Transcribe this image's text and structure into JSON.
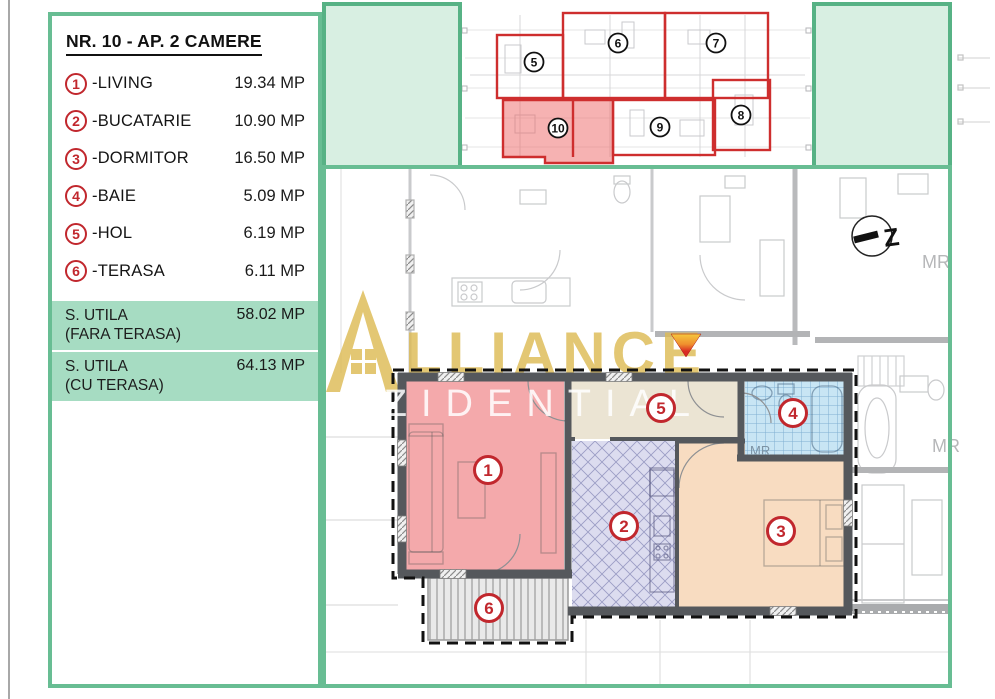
{
  "legend": {
    "title": "NR. 10 - AP. 2 CAMERE",
    "items": [
      {
        "num": "1",
        "label": "-LIVING",
        "value": "19.34 MP"
      },
      {
        "num": "2",
        "label": "-BUCATARIE",
        "value": "10.90 MP"
      },
      {
        "num": "3",
        "label": "-DORMITOR",
        "value": "16.50 MP"
      },
      {
        "num": "4",
        "label": "-BAIE",
        "value": "5.09 MP"
      },
      {
        "num": "5",
        "label": "-HOL",
        "value": "6.19 MP"
      },
      {
        "num": "6",
        "label": "-TERASA",
        "value": "6.11 MP"
      }
    ],
    "totals": [
      {
        "label": "S. UTILA",
        "sub": "(FARA TERASA)",
        "value": "58.02 MP"
      },
      {
        "label": "S. UTILA",
        "sub": "(CU TERASA)",
        "value": "64.13 MP"
      }
    ]
  },
  "overview": {
    "units": [
      "5",
      "6",
      "7",
      "8",
      "9",
      "10"
    ],
    "highlighted_unit": "10"
  },
  "plan": {
    "room_badges": [
      "1",
      "2",
      "3",
      "4",
      "5",
      "6"
    ],
    "mr_labels": [
      "MR",
      "MR",
      "MR"
    ],
    "north_label": "Z"
  },
  "watermark": {
    "brand_visible_text": "LLIANCE",
    "sub": "REZIDENTIAL"
  },
  "colors": {
    "frame_green": "#68bd93",
    "light_green_fill": "#d8efe2",
    "totals_green": "#a6dcc2",
    "badge_red": "#c1272d",
    "overview_red": "#ce2e2e",
    "living_pink": "#f4a9ab",
    "hol_beige": "#ebe4d3",
    "baie_blue": "#c8e5f4",
    "bucatarie_lavender": "#dcdcef",
    "dormitor_peach": "#f8dcc1",
    "terasa_gray": "#e9e9e9",
    "wall_gray": "#55585c",
    "watermark_gold": "#ddbb55"
  }
}
